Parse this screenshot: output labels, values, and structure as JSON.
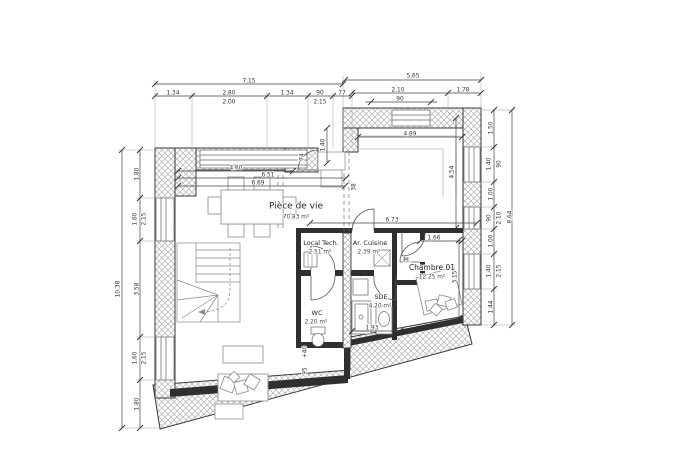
{
  "plan": {
    "colors": {
      "background": "#ffffff",
      "wall_line": "#3a3a3a",
      "hatch": "#9a9a9a",
      "dim_text": "#333333"
    },
    "rooms": [
      {
        "name": "Pièce de vie",
        "area": "70.83 m²",
        "nx": 296,
        "ny": 206,
        "ax": 296,
        "ay": 217,
        "size": 9
      },
      {
        "name": "Local Tech.",
        "area": "2.51 m²",
        "nx": 321,
        "ny": 243,
        "ax": 320,
        "ay": 252,
        "size": 6.5
      },
      {
        "name": "Ar. Cuisine",
        "area": "2.39 m²",
        "nx": 370,
        "ny": 243,
        "ax": 369,
        "ay": 252,
        "size": 6.5
      },
      {
        "name": "Pl.",
        "area": "",
        "nx": 407,
        "ny": 260,
        "ax": 0,
        "ay": 0,
        "size": 6.5
      },
      {
        "name": "SDE",
        "area": "4.20 m²",
        "nx": 381,
        "ny": 297,
        "ax": 380,
        "ay": 306,
        "size": 6.5
      },
      {
        "name": "WC",
        "area": "2.20 m²",
        "nx": 317,
        "ny": 313,
        "ax": 316,
        "ay": 322,
        "size": 6.5
      },
      {
        "name": "Chambre 01",
        "area": "12.25 m²",
        "nx": 432,
        "ny": 268,
        "ax": 432,
        "ay": 277,
        "size": 7.5
      }
    ],
    "dimensions": [
      {
        "t": "7.15",
        "x": 249,
        "y": 81
      },
      {
        "t": "5.65",
        "x": 413,
        "y": 76
      },
      {
        "t": "1.34",
        "x": 173,
        "y": 93
      },
      {
        "t": "2.80",
        "x": 229,
        "y": 93
      },
      {
        "t": "2.00",
        "x": 229,
        "y": 102
      },
      {
        "t": "1.34",
        "x": 287,
        "y": 93
      },
      {
        "t": "90",
        "x": 320,
        "y": 93
      },
      {
        "t": "2.15",
        "x": 320,
        "y": 102
      },
      {
        "t": "77",
        "x": 342,
        "y": 93
      },
      {
        "t": "2.10",
        "x": 398,
        "y": 90
      },
      {
        "t": "1.78",
        "x": 463,
        "y": 90
      },
      {
        "t": "90",
        "x": 400,
        "y": 99
      },
      {
        "t": "10.38",
        "x": 118,
        "y": 289,
        "r": -90
      },
      {
        "t": "1.80",
        "x": 137,
        "y": 174,
        "r": -90
      },
      {
        "t": "1.60",
        "x": 135,
        "y": 219,
        "r": -90
      },
      {
        "t": "2.15",
        "x": 144,
        "y": 219,
        "r": -90
      },
      {
        "t": "3.58",
        "x": 137,
        "y": 289,
        "r": -90
      },
      {
        "t": "1.60",
        "x": 135,
        "y": 358,
        "r": -90
      },
      {
        "t": "2.15",
        "x": 144,
        "y": 358,
        "r": -90
      },
      {
        "t": "1.80",
        "x": 137,
        "y": 404,
        "r": -90
      },
      {
        "t": "1.50",
        "x": 491,
        "y": 128,
        "r": -90
      },
      {
        "t": "1.40",
        "x": 489,
        "y": 164,
        "r": -90
      },
      {
        "t": "90",
        "x": 499,
        "y": 164,
        "r": -90
      },
      {
        "t": "1.00",
        "x": 491,
        "y": 194,
        "r": -90
      },
      {
        "t": "90",
        "x": 489,
        "y": 218,
        "r": -90
      },
      {
        "t": "2.10",
        "x": 499,
        "y": 218,
        "r": -90
      },
      {
        "t": "1.00",
        "x": 491,
        "y": 241,
        "r": -90
      },
      {
        "t": "1.40",
        "x": 489,
        "y": 271,
        "r": -90
      },
      {
        "t": "2.15",
        "x": 499,
        "y": 271,
        "r": -90
      },
      {
        "t": "1.44",
        "x": 491,
        "y": 307,
        "r": -90
      },
      {
        "t": "8.64",
        "x": 510,
        "y": 217,
        "r": -90
      },
      {
        "t": "4.60",
        "x": 236,
        "y": 168
      },
      {
        "t": "6.51",
        "x": 268,
        "y": 175
      },
      {
        "t": "6.69",
        "x": 258,
        "y": 183
      },
      {
        "t": "4.89",
        "x": 410,
        "y": 134
      },
      {
        "t": "4.54",
        "x": 452,
        "y": 172,
        "r": -90
      },
      {
        "t": "6.73",
        "x": 392,
        "y": 220
      },
      {
        "t": "1.66",
        "x": 434,
        "y": 238
      },
      {
        "t": "3.15",
        "x": 455,
        "y": 277,
        "r": -90
      },
      {
        "t": "1.93",
        "x": 372,
        "y": 328
      },
      {
        "t": "38",
        "x": 354,
        "y": 187,
        "r": -90
      },
      {
        "t": "1.40",
        "x": 323,
        "y": 145,
        "r": -90
      },
      {
        "t": "74",
        "x": 302,
        "y": 157,
        "r": -90
      },
      {
        "t": "95",
        "x": 305,
        "y": 371,
        "r": -90
      },
      {
        "t": "+40",
        "x": 305,
        "y": 352,
        "r": -90
      }
    ]
  }
}
